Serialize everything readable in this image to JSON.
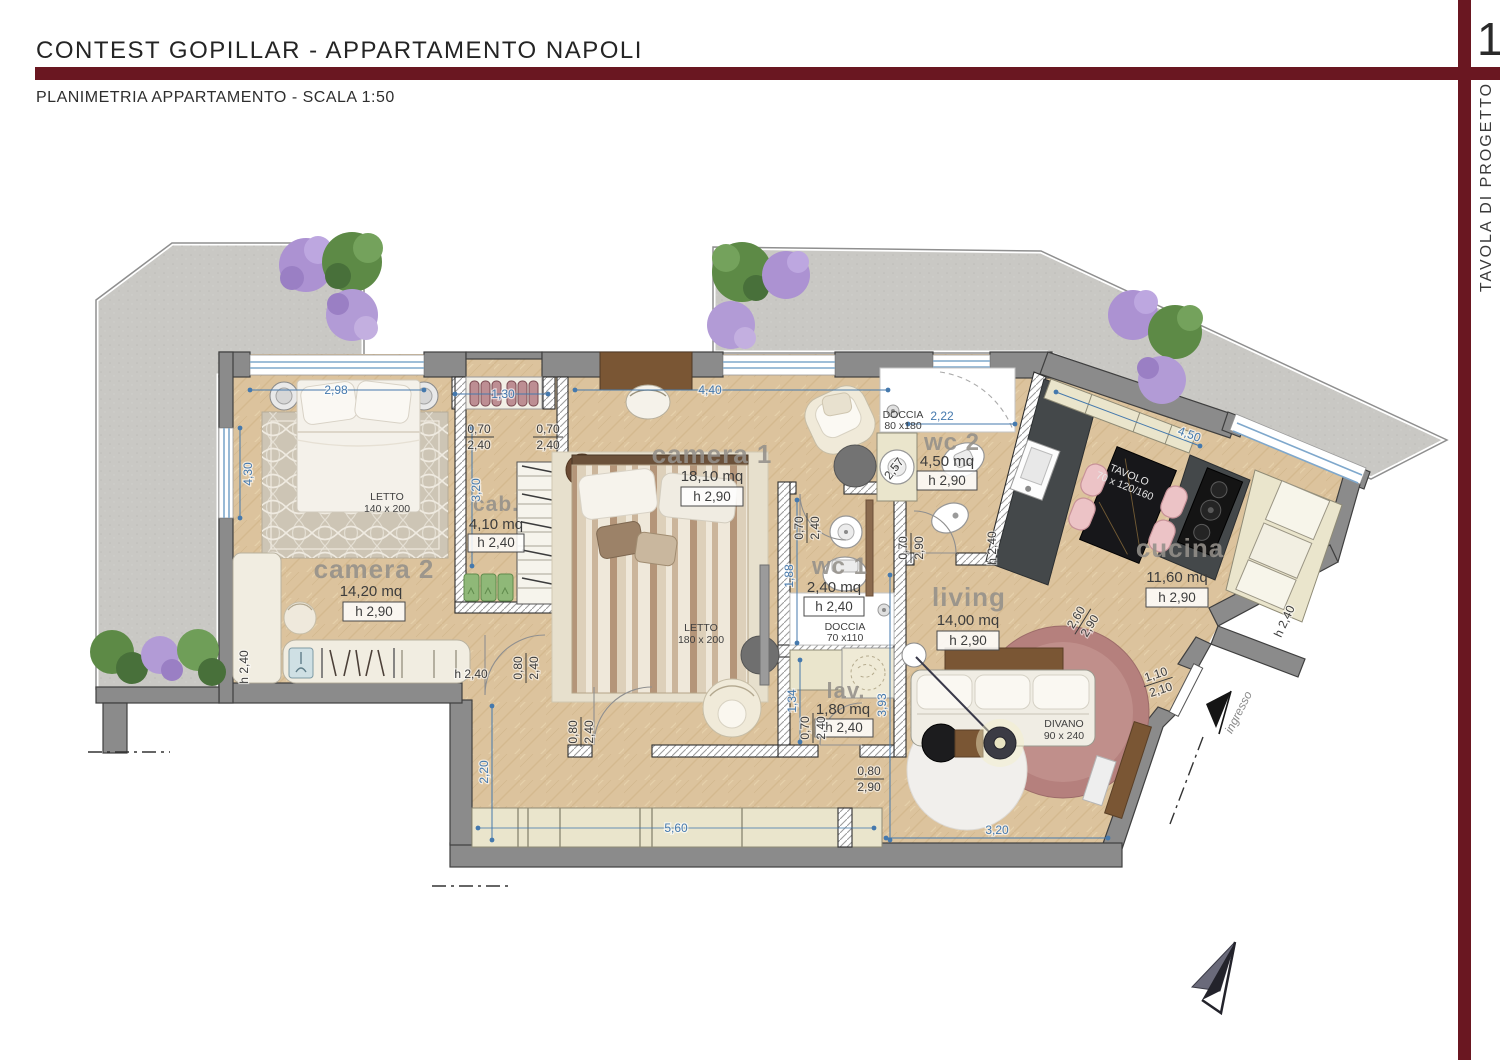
{
  "header": {
    "title": "CONTEST GOPILLAR - APPARTAMENTO NAPOLI",
    "subtitle": "PLANIMETRIA APPARTAMENTO - SCALA 1:50",
    "page_number": "1",
    "sidebar_label": "TAVOLA DI PROGETTO"
  },
  "colors": {
    "accent": "#6a1721",
    "dim_blue": "#4579ad",
    "wall_gray": "#8b8b8b",
    "wood": "#dcc39d",
    "stone": "#c9c8c4"
  },
  "rooms": {
    "camera2": {
      "label": "camera 2",
      "area": "14,20 mq",
      "height": "h 2,90"
    },
    "cab": {
      "label": "cab.",
      "area": "4,10 mq",
      "height": "h 2,40"
    },
    "camera1": {
      "label": "camera 1",
      "area": "18,10 mq",
      "height": "h 2,90"
    },
    "wc1": {
      "label": "wc 1",
      "area": "2,40 mq",
      "height": "h 2,40"
    },
    "lav": {
      "label": "lav.",
      "area": "1,80 mq",
      "height": "h 2,40"
    },
    "wc2": {
      "label": "wc 2",
      "area": "4,50 mq",
      "height": "h 2,90"
    },
    "cucina": {
      "label": "cucina",
      "area": "11,60 mq",
      "height": "h 2,90"
    },
    "living": {
      "label": "living",
      "area": "14,00 mq",
      "height": "h 2,90"
    }
  },
  "furniture": {
    "letto_camera2": {
      "l1": "LETTO",
      "l2": "140 x 200"
    },
    "letto_camera1": {
      "l1": "LETTO",
      "l2": "180 x 200"
    },
    "doccia_wc1": {
      "l1": "DOCCIA",
      "l2": "70 x110"
    },
    "doccia_wc2": {
      "l1": "DOCCIA",
      "l2": "80 x180"
    },
    "tavolo": {
      "l1": "TAVOLO",
      "l2": "70 x 120/160"
    },
    "divano": {
      "l1": "DIVANO",
      "l2": "90 x 240"
    }
  },
  "dimensions": {
    "win_camera2_top": "2,98",
    "closet_cab_top": "1,30",
    "win_camera1_top": "4,40",
    "wc2_top": "2,22",
    "win_cucina": "4,50",
    "win_camera2_left": "4,30",
    "cab_depth": "3,20",
    "wc1_len": "1,88",
    "lav_len": "1,34",
    "living_side": "3,93",
    "corridor": "2,20",
    "closet_bottom": "5,60",
    "living_bottom": "3,20",
    "wc2_counter": "2,57",
    "door_cab_1": {
      "t": "0,70",
      "b": "2,40"
    },
    "door_cab_2": {
      "t": "0,70",
      "b": "2,40"
    },
    "door_wc1": {
      "t": "0,70",
      "b": "2,40"
    },
    "door_lav": {
      "t": "0,70",
      "b": "2,40"
    },
    "door_living": {
      "t": "0,70",
      "b": "2,90"
    },
    "cucina_pass": {
      "t": "2,60",
      "b": "2,90"
    },
    "entry_door": {
      "t": "1,10",
      "b": "2,10"
    },
    "door_camera2": {
      "t": "0,80",
      "b": "2,40"
    },
    "door_camera1": {
      "t": "0,80",
      "b": "2,40"
    },
    "door_corridor": {
      "t": "0,80",
      "b": "2,90"
    },
    "h_left_wall": "h 2,40",
    "h_camera2_desk": "h 2,40",
    "h_kitchen_door": "h 2,40",
    "h_cucina_cab": "h 2,40"
  },
  "annotations": {
    "ingresso": "ingresso"
  }
}
